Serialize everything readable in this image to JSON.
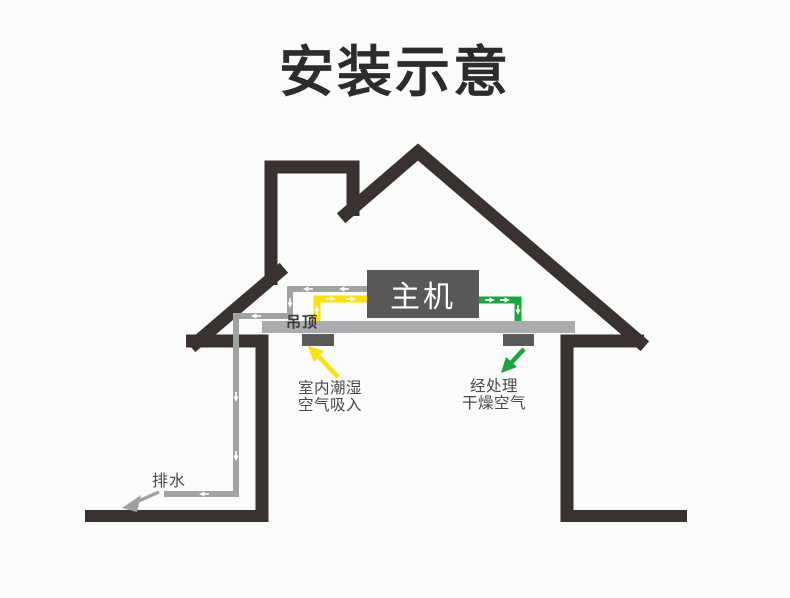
{
  "title": "安装示意",
  "diagram": {
    "main_unit_label": "主机",
    "ceiling_label": "吊顶",
    "intake_label_line1": "室内潮湿",
    "intake_label_line2": "空气吸入",
    "outlet_label_line1": "经处理",
    "outlet_label_line2": "干燥空气",
    "drain_label": "排水",
    "colors": {
      "outline": "#3a3230",
      "ceiling": "#abacad",
      "unit": "#595757",
      "vent": "#5a5a5a",
      "pipe_gray": "#a1a2a2",
      "pipe_yellow": "#ffe100",
      "pipe_green": "#18a73c",
      "arrow_gray": "#9fa0a0",
      "text": "#4c4949",
      "title": "#2e2c2b",
      "bg": "#fbfbfb"
    }
  }
}
